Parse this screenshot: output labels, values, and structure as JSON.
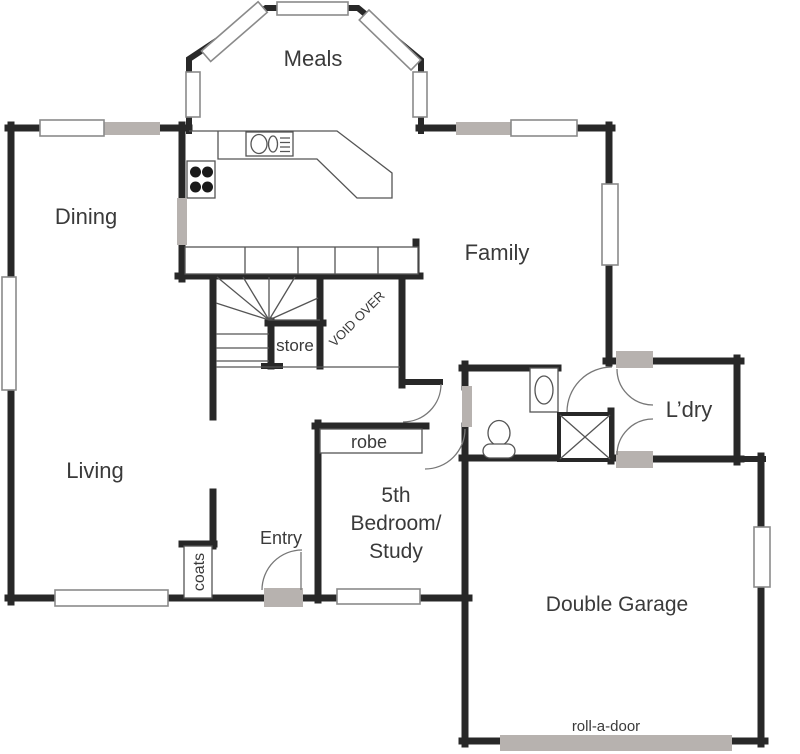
{
  "plan": {
    "rooms": {
      "meals": {
        "label": "Meals"
      },
      "dining": {
        "label": "Dining"
      },
      "family": {
        "label": "Family"
      },
      "living": {
        "label": "Living"
      },
      "laundry": {
        "label": "L’dry"
      },
      "garage": {
        "label": "Double Garage"
      },
      "bedroom5": {
        "line1": "5th",
        "line2": "Bedroom/",
        "line3": "Study"
      }
    },
    "features": {
      "entry": {
        "label": "Entry"
      },
      "robe": {
        "label": "robe"
      },
      "store": {
        "label": "store"
      },
      "coats": {
        "label": "coats"
      },
      "void": {
        "label": "VOID OVER"
      },
      "roll_a_door": {
        "label": "roll-a-door"
      }
    },
    "colors": {
      "wall": "#282828",
      "door_threshold_gray": "#b7b2af",
      "window_border_gray": "#8a8a8a",
      "label_text": "#3a3a3a",
      "background": "#ffffff"
    }
  }
}
